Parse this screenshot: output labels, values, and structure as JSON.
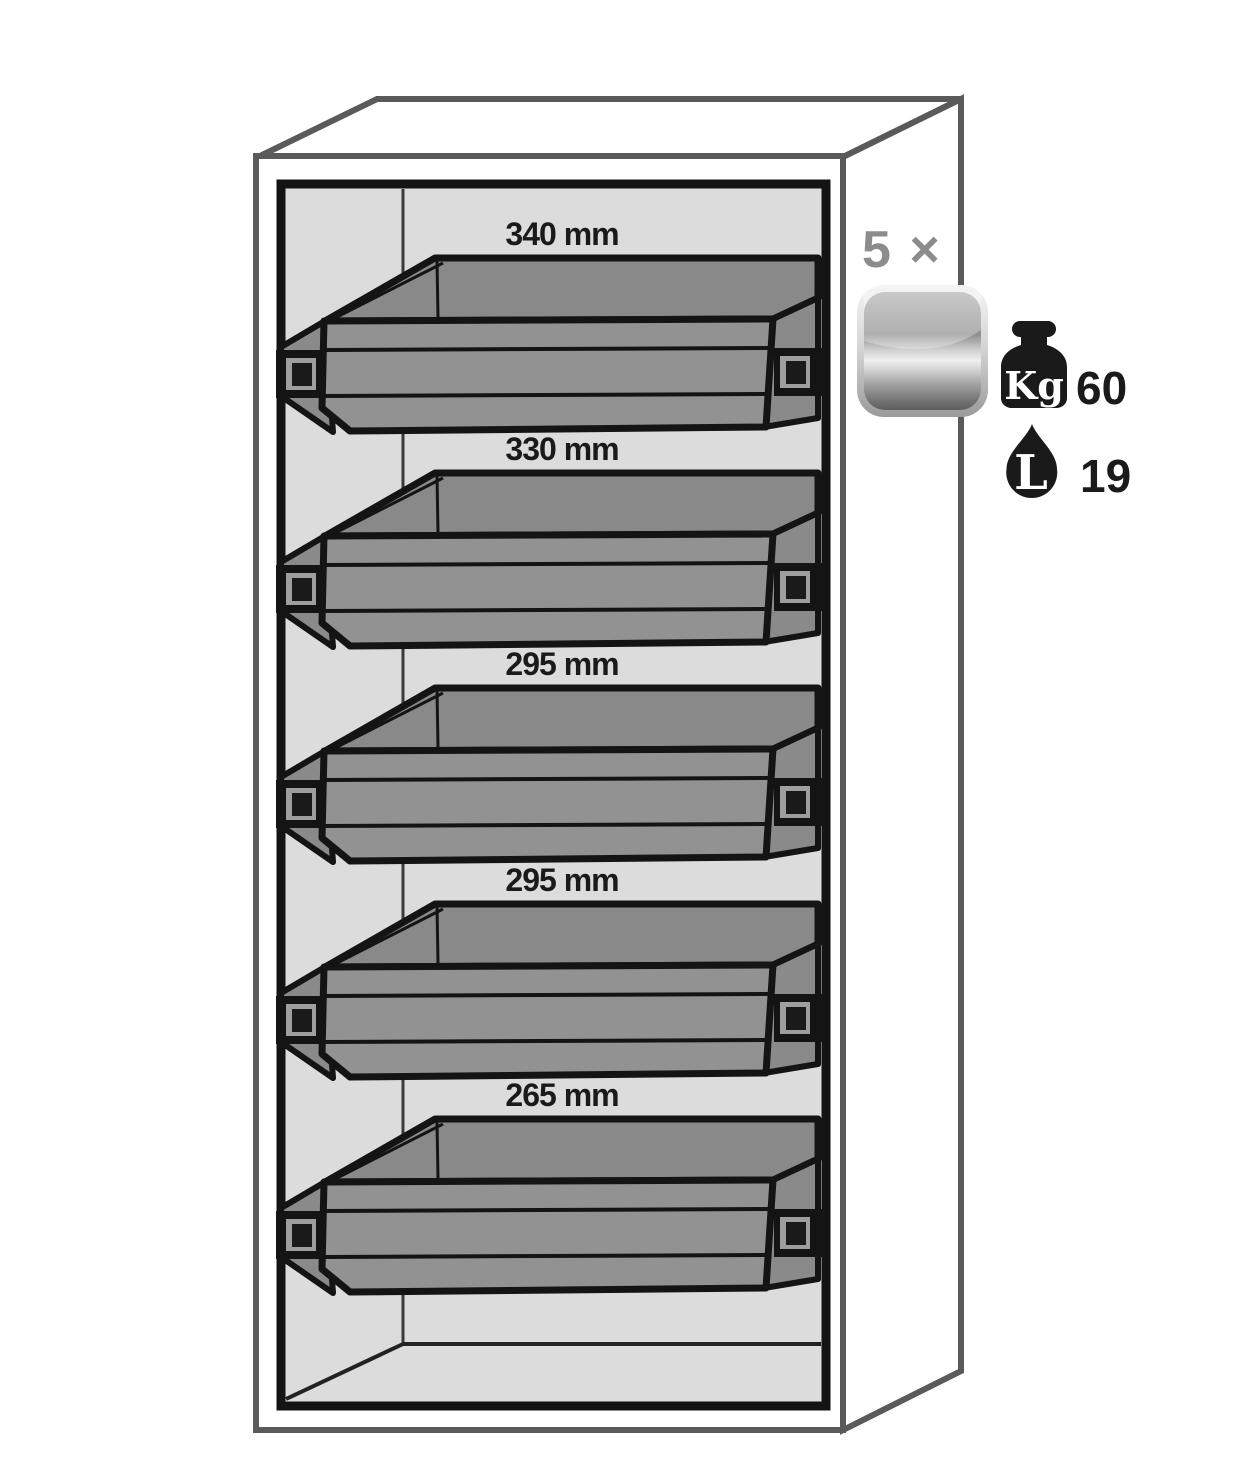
{
  "trays": [
    {
      "label": "340 mm"
    },
    {
      "label": "330 mm"
    },
    {
      "label": "295 mm"
    },
    {
      "label": "295 mm"
    },
    {
      "label": "265 mm"
    }
  ],
  "side": {
    "count_label": "5 ×",
    "load": {
      "unit": "Kg",
      "value": "60"
    },
    "volume": {
      "unit": "L",
      "value": "19"
    }
  },
  "colors": {
    "tray_gray": "#8e8e8e",
    "interior_gray": "#dcdcdc",
    "cabinet_outline": "#5a5a5a",
    "frame_black": "#141414",
    "count_text_gray": "#8c8c8c",
    "icon_black": "#1a1a1a"
  }
}
